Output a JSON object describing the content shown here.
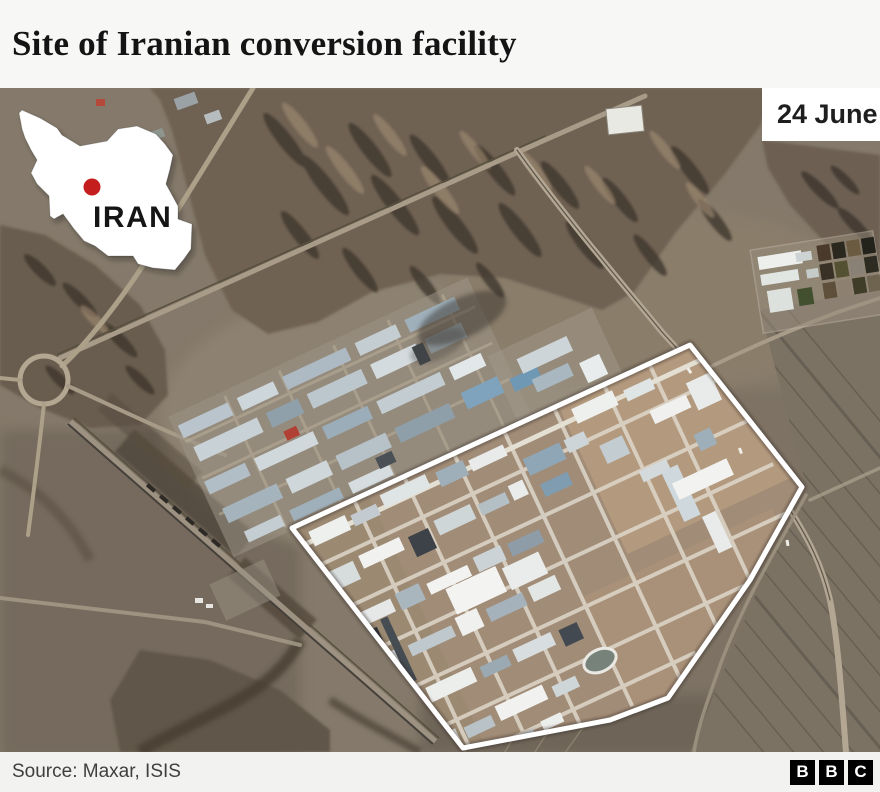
{
  "header": {
    "title": "Site of Iranian conversion facility"
  },
  "map": {
    "date_label": "24 June",
    "inset": {
      "country_label": "IRAN",
      "marker_color": "#c41e1e"
    },
    "highlight_outline_color": "#ffffff"
  },
  "footer": {
    "source": "Source: Maxar, ISIS",
    "logo_letters": [
      "B",
      "B",
      "C"
    ]
  },
  "colors": {
    "accent_red": "#c41e1e",
    "terrain_base": "#84796a",
    "header_bg": "#f7f7f6",
    "footer_bg": "#f2f2f1",
    "logo_bg": "#000000"
  }
}
